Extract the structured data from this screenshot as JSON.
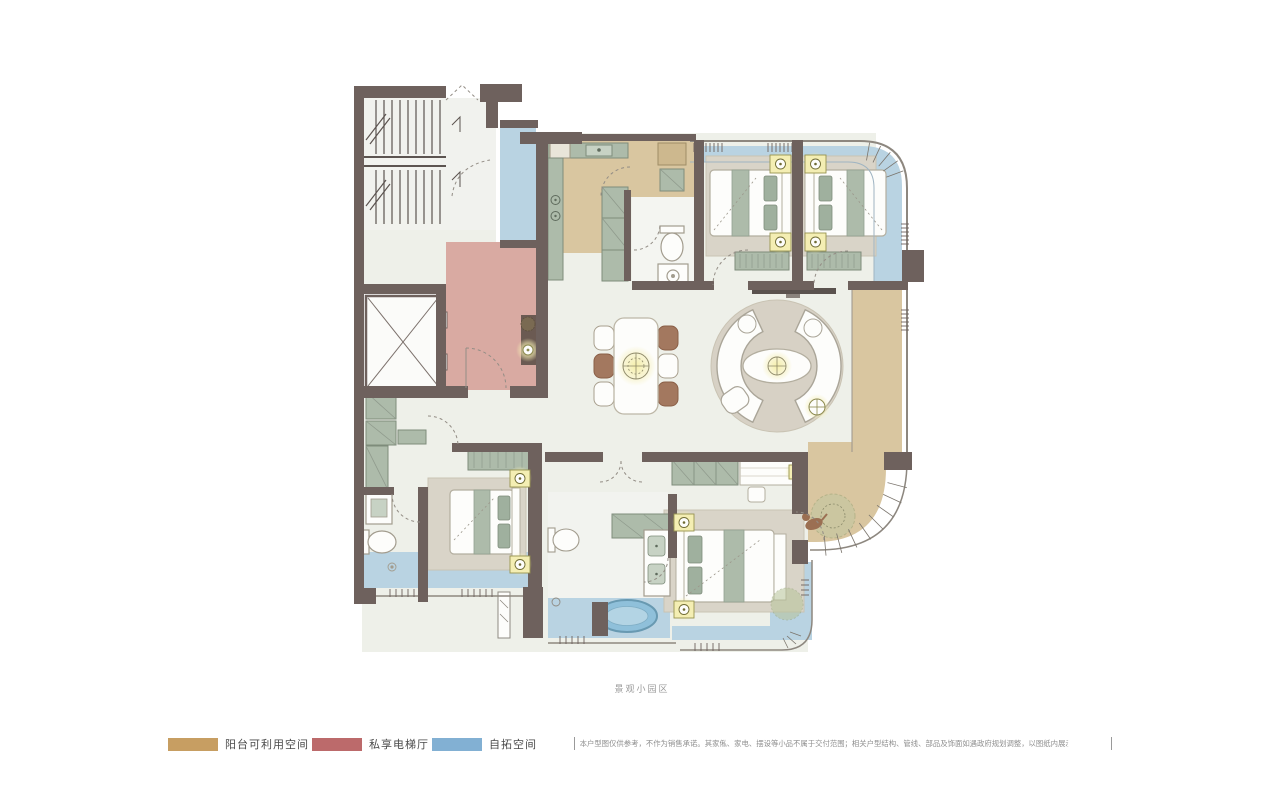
{
  "caption": "景观小园区",
  "legend": {
    "items": [
      {
        "id": "balcony-usable-space",
        "label": "阳台可利用空间",
        "color": "#c79e62"
      },
      {
        "id": "private-elevator-hall",
        "label": "私享电梯厅",
        "color": "#bc6a6b"
      },
      {
        "id": "expandable-space",
        "label": "自拓空间",
        "color": "#82b0d3"
      }
    ]
  },
  "disclaimer": "本户型图仅供参考，不作为销售承诺。其家俬、家电、摆设等小品不属于交付范围；相关户型结构、管线、部品及饰面如遇政府规划调整，以图纸内展示为准，最终以实际交付为准。",
  "plan": {
    "zone_colors": {
      "balcony_usable": "#d9c6a0",
      "private_elevator_hall": "#d9aaa2",
      "expandable": "#b9d3e2",
      "floor": "#eef0e9",
      "wall": "#6e615d",
      "lamp_glow": "#f4eeb3",
      "bathtub": "#8fc0da",
      "furniture_sage": "#adbbaa",
      "rug": "#d9d4c8",
      "wood_chair": "#a3785f"
    }
  }
}
